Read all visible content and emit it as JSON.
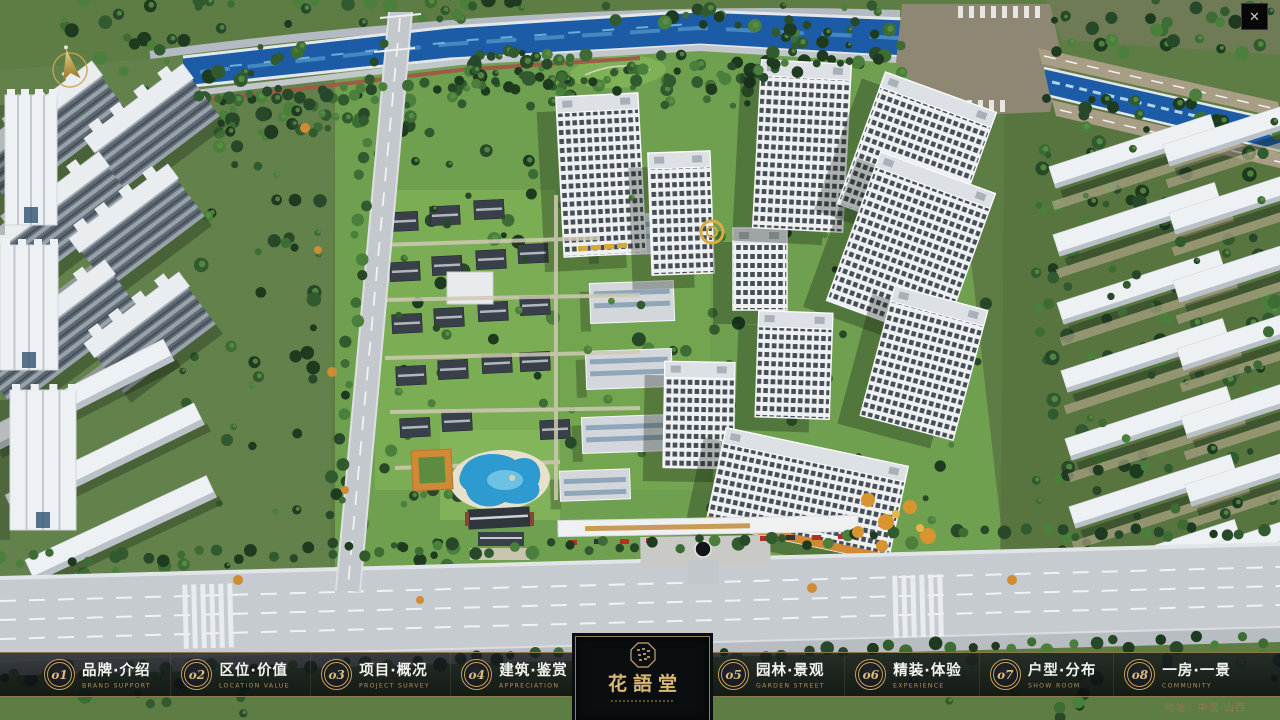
{
  "window": {
    "close_glyph": "✕"
  },
  "nav": {
    "items": [
      {
        "num": "o1",
        "label": "品牌·介绍",
        "sub": "BRAND SUPPORT"
      },
      {
        "num": "o2",
        "label": "区位·价值",
        "sub": "LOCATION VALUE"
      },
      {
        "num": "o3",
        "label": "项目·概况",
        "sub": "PROJECT SURVEY"
      },
      {
        "num": "o4",
        "label": "建筑·鉴赏",
        "sub": "APPRECIATION"
      },
      {
        "num": "o5",
        "label": "园林·景观",
        "sub": "GARDEN STREET"
      },
      {
        "num": "o6",
        "label": "精装·体验",
        "sub": "EXPERIENCE"
      },
      {
        "num": "o7",
        "label": "户型·分布",
        "sub": "SHOW ROOM"
      },
      {
        "num": "o8",
        "label": "一房·一景",
        "sub": "COMMUNITY"
      }
    ]
  },
  "logo": {
    "title": "花語堂"
  },
  "footer": {
    "address": "地址：中国·山西"
  },
  "colors": {
    "accent_gold": "#c8a35c",
    "logo_gold": "#d9b873",
    "bar_background": "#14171b",
    "river_blue": "#1c5ca6",
    "grass_green": "#6fa04f"
  }
}
